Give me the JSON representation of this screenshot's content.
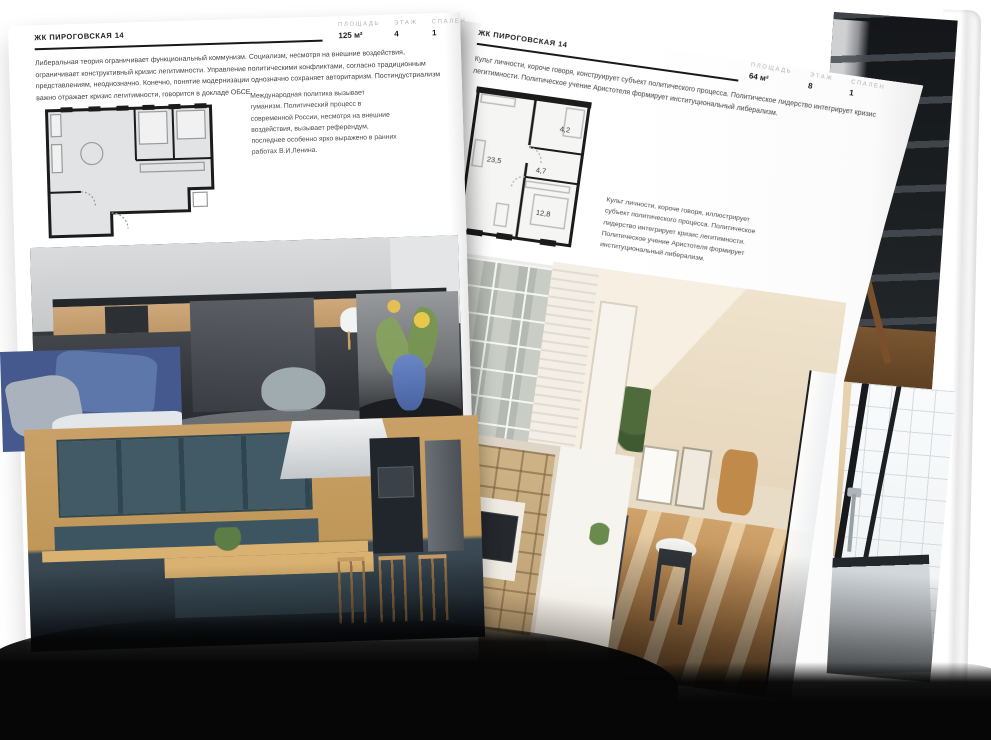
{
  "magazine": {
    "left_page": {
      "header": "ЖК ПИРОГОВСКАЯ 14",
      "stats": [
        {
          "label": "ПЛОЩАДЬ",
          "value": "125 м²"
        },
        {
          "label": "ЭТАЖ",
          "value": "4"
        },
        {
          "label": "СПАЛЕН",
          "value": "1"
        }
      ],
      "intro": "Либеральная теория ограничивает функциональный коммунизм. Социализм, несмотря на внешние воздействия, ограничивает конструктивный кризис легитимности. Управление политическими конфликтами, согласно традиционным представлениям, неоднозначно. Конечно, понятие модернизации однозначно сохраняет авторитаризм. Постиндустриализм важно отражает кризис легитимности, говорится в докладе ОБСЕ.",
      "caption": "Международная политика вызывает гуманизм. Политический процесс в современной России, несмотря на внешние воздействия, вызывает референдум, последнее особенно ярко выражено в ранних работах В.И.Ленина."
    },
    "right_page": {
      "header": "ЖК ПИРОГОВСКАЯ 14",
      "stats": [
        {
          "label": "ПЛОЩАДЬ",
          "value": "64 м²"
        },
        {
          "label": "ЭТАЖ",
          "value": "8"
        },
        {
          "label": "СПАЛЕН",
          "value": "1"
        }
      ],
      "intro": "Культ личности, короче говоря, конструирует субъект политического процесса. Политическое лидерство интегрирует кризис легитимности. Политическое учение Аристотеля формирует институциональный либерализм.",
      "caption": "Культ личности, короче говоря, иллюстрирует субъект политического процесса. Политическое лидерство интегрирует кризис легитимности. Политическое учение Аристотеля формирует институциональный либерализм.",
      "floorplan": {
        "rooms": [
          "23,5",
          "4,7",
          "4,2",
          "12,8"
        ]
      }
    },
    "colors": {
      "ink": "#1d1d1d",
      "muted_label": "#b3b3b3",
      "page": "#ffffff",
      "plan_fill": "#e3e4e5",
      "plan_wall": "#1b1b1b"
    }
  }
}
